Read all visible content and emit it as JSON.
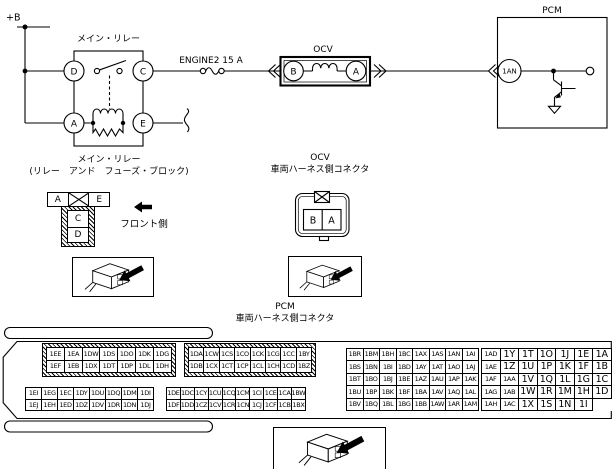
{
  "colors": {
    "ink": "#000000",
    "paper": "#ffffff"
  },
  "icons": {
    "front_arrow": "solid-left-arrow",
    "connector_photo": "connector-3d-sketch-with-arrow"
  },
  "schematic": {
    "power_label": "+B",
    "fuse_label": "ENGINE2 15 A",
    "relay": {
      "title": "メイン・リレー",
      "terminal_d": "D",
      "terminal_c": "C",
      "terminal_a": "A",
      "terminal_e": "E"
    },
    "ocv": {
      "title": "OCV",
      "terminal_b": "B",
      "terminal_a": "A"
    },
    "pcm": {
      "title": "PCM",
      "terminal": "1AN"
    }
  },
  "relay_connector": {
    "title": "メイン・リレー",
    "subtitle": "(リレー　アンド　フューズ・ブロック)",
    "pin_a": "A",
    "pin_e": "E",
    "pin_c": "C",
    "pin_d": "D",
    "front_label": "フロント側"
  },
  "ocv_connector": {
    "title": "OCV",
    "subtitle": "車両ハーネス側コネクタ",
    "pin_b": "B",
    "pin_a": "A"
  },
  "pcm_connector": {
    "title": "PCM",
    "subtitle": "車両ハーネス側コネクタ",
    "grid1_top": [
      [
        "1EE",
        "1EA",
        "1DW",
        "1DS",
        "1DO",
        "1DK",
        "1DG"
      ],
      [
        "1EF",
        "1EB",
        "1DX",
        "1DT",
        "1DP",
        "1DL",
        "1DH"
      ]
    ],
    "grid1_bottom": [
      [
        "1EI",
        "1EG",
        "1EC",
        "1DY",
        "1DU",
        "1DQ",
        "1DM",
        "1DI"
      ],
      [
        "1EJ",
        "1EH",
        "1ED",
        "1DZ",
        "1DV",
        "1DR",
        "1DN",
        "1DJ"
      ]
    ],
    "grid2_top": [
      [
        "1DA",
        "1CW",
        "1CS",
        "1CO",
        "1CK",
        "1CG",
        "1CC",
        "1BY"
      ],
      [
        "1DB",
        "1CX",
        "1CT",
        "1CP",
        "1CL",
        "1CH",
        "1CD",
        "1BZ"
      ]
    ],
    "grid2_bottom": [
      [
        "1DE",
        "1DC",
        "1CY",
        "1CU",
        "1CQ",
        "1CM",
        "1CI",
        "1CE",
        "1CA",
        "1BW"
      ],
      [
        "1DF",
        "1DD",
        "1CZ",
        "1CV",
        "1CR",
        "1CN",
        "1CJ",
        "1CF",
        "1CB",
        "1BX"
      ]
    ],
    "grid3": [
      [
        "1BR",
        "1BM",
        "1BH",
        "1BC",
        "1AX",
        "1AS",
        "1AN",
        "1AI"
      ],
      [
        "1BS",
        "1BN",
        "1BI",
        "1BD",
        "1AY",
        "1AT",
        "1AO",
        "1AJ"
      ],
      [
        "1BT",
        "1BO",
        "1BJ",
        "1BE",
        "1AZ",
        "1AU",
        "1AP",
        "1AK"
      ],
      [
        "1BU",
        "1BP",
        "1BK",
        "1BF",
        "1BA",
        "1AV",
        "1AQ",
        "1AL"
      ],
      [
        "1BV",
        "1BQ",
        "1BL",
        "1BG",
        "1BB",
        "1AW",
        "1AR",
        "1AM"
      ]
    ],
    "grid4": [
      [
        "1AD",
        "1Y",
        "1T",
        "1O",
        "1J",
        "1E",
        "1A"
      ],
      [
        "1AE",
        "1Z",
        "1U",
        "1P",
        "1K",
        "1F",
        "1B"
      ],
      [
        "1AF",
        "1AA",
        "1V",
        "1Q",
        "1L",
        "1G",
        "1C"
      ],
      [
        "1AG",
        "1AB",
        "1W",
        "1R",
        "1M",
        "1H",
        "1D"
      ],
      [
        "1AH",
        "1AC",
        "1X",
        "1S",
        "1N",
        "1I"
      ]
    ]
  }
}
